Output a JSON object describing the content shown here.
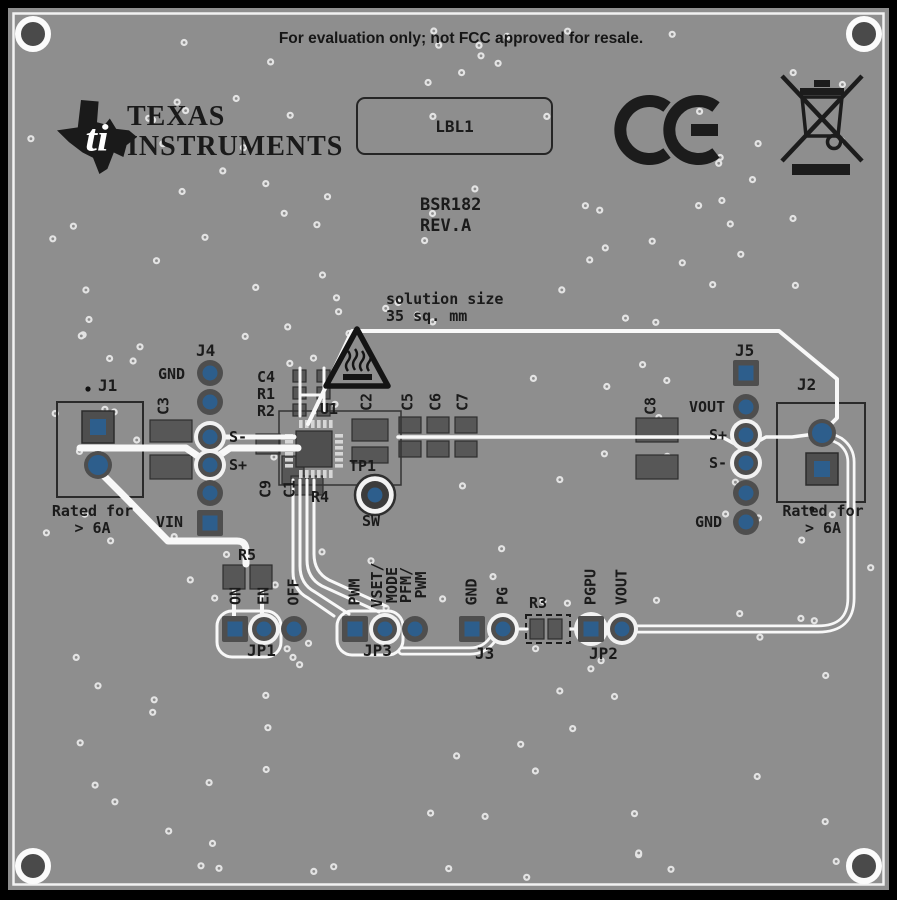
{
  "header": {
    "eval_notice": "For evaluation only; not FCC approved for resale.",
    "logo_line1": "TEXAS",
    "logo_line2": "INSTRUMENTS",
    "logo_bug_letters": "ti",
    "label_box": "LBL1",
    "board_name": "BSR182",
    "board_rev": "REV.A"
  },
  "annotations": {
    "solution_size": "solution size\n35 sq. mm",
    "rated_for_left": "Rated for\n> 6A",
    "rated_for_right": "Rated for\n> 6A"
  },
  "refdes": {
    "j1": "J1",
    "j2": "J2",
    "j3": "J3",
    "j4": "J4",
    "j5": "J5",
    "jp1": "JP1",
    "jp2": "JP2",
    "jp3": "JP3",
    "u1": "U1",
    "tp1": "TP1",
    "c1": "C1",
    "c2": "C2",
    "c3": "C3",
    "c4": "C4",
    "c5": "C5",
    "c6": "C6",
    "c7": "C7",
    "c8": "C8",
    "c9": "C9",
    "r1": "R1",
    "r2": "R2",
    "r3": "R3",
    "r4": "R4",
    "r5": "R5"
  },
  "signals": {
    "j4_gnd": "GND",
    "j4_sminus": "S-",
    "j4_splus": "S+",
    "j4_vin": "VIN",
    "j5_vout": "VOUT",
    "j5_splus": "S+",
    "j5_sminus": "S-",
    "j5_gnd": "GND",
    "sw": "SW",
    "on": "ON",
    "en": "EN",
    "off": "OFF",
    "pwm": "PWM",
    "vset_mode": "VSET/\nMODE",
    "pfm_pwm": "PFM/\nPWM",
    "gnd": "GND",
    "pg": "PG",
    "pgpu": "PGPU",
    "vout": "VOUT"
  },
  "colors": {
    "board": "#8e8e8e",
    "silkscreen": "#1b1b1b",
    "trace": "#f8f8f8",
    "pad_copper_blue": "#2d5e8c",
    "pad_annulus": "#4e4e4e",
    "component_body": "#575757"
  }
}
